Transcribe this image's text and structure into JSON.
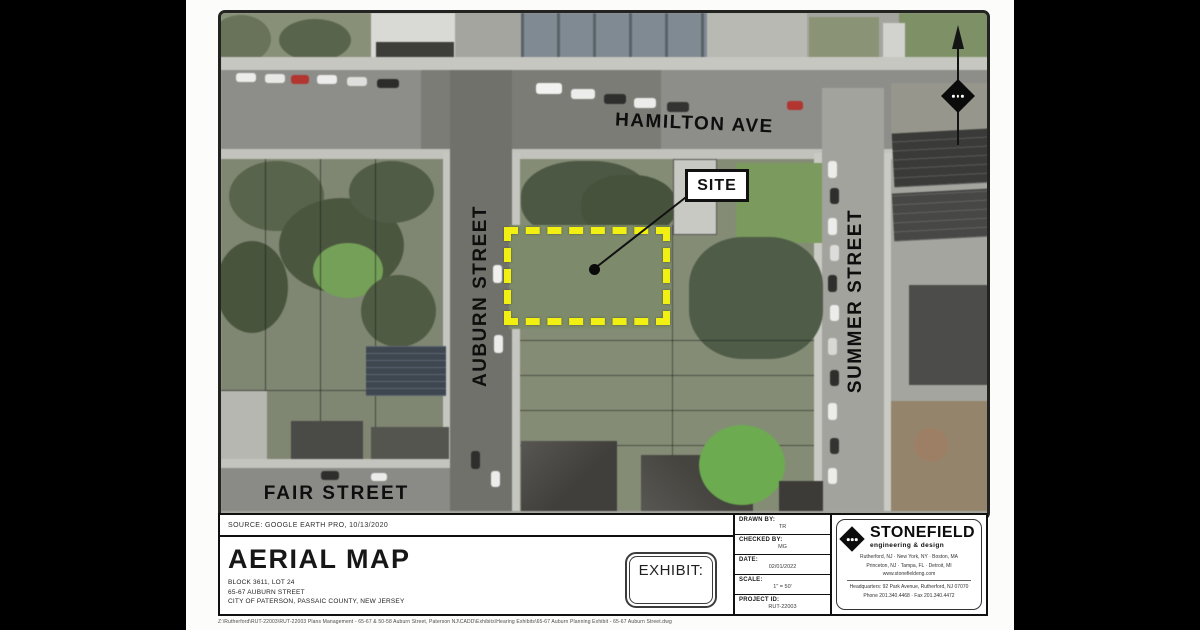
{
  "map": {
    "street_labels": {
      "hamilton": "HAMILTON AVE",
      "auburn": "AUBURN STREET",
      "summer": "SUMMER STREET",
      "fair": "FAIR STREET"
    },
    "site_label": "SITE",
    "site_outline_color": "#f2f013"
  },
  "title_block": {
    "source": "SOURCE: GOOGLE EARTH PRO, 10/13/2020",
    "title": "AERIAL MAP",
    "address_lines": [
      "BLOCK 3611, LOT 24",
      "65-67 AUBURN STREET",
      "CITY OF PATERSON, PASSAIC COUNTY, NEW JERSEY"
    ],
    "exhibit_label": "EXHIBIT:",
    "fields": [
      {
        "label": "DRAWN BY:",
        "value": "TR"
      },
      {
        "label": "CHECKED BY:",
        "value": "MG"
      },
      {
        "label": "DATE:",
        "value": "02/01/2022"
      },
      {
        "label": "SCALE:",
        "value": "1\" = 50'"
      },
      {
        "label": "PROJECT ID:",
        "value": "RUT-22003"
      }
    ],
    "firm": {
      "name": "STONEFIELD",
      "tagline": "engineering & design",
      "cities_line1": "Rutherford, NJ  ·  New York, NY  ·  Boston, MA",
      "cities_line2": "Princeton, NJ  ·  Tampa, FL  ·  Detroit, MI",
      "website": "www.stonefieldeng.com",
      "headquarters": "Headquarters:  92 Park Avenue, Rutherford, NJ 07070",
      "phone_fax": "Phone 201.340.4468  ·  Fax 201.340.4472"
    },
    "file_path": "Z:\\Rutherford\\RUT-22003\\RUT-22003 Plans Management - 65-67 & 50-58 Auburn Street, Paterson NJ\\CADD\\Exhibits\\Hearing Exhibits\\65-67 Auburn Planning Exhibit - 65-67 Auburn Street.dwg"
  }
}
